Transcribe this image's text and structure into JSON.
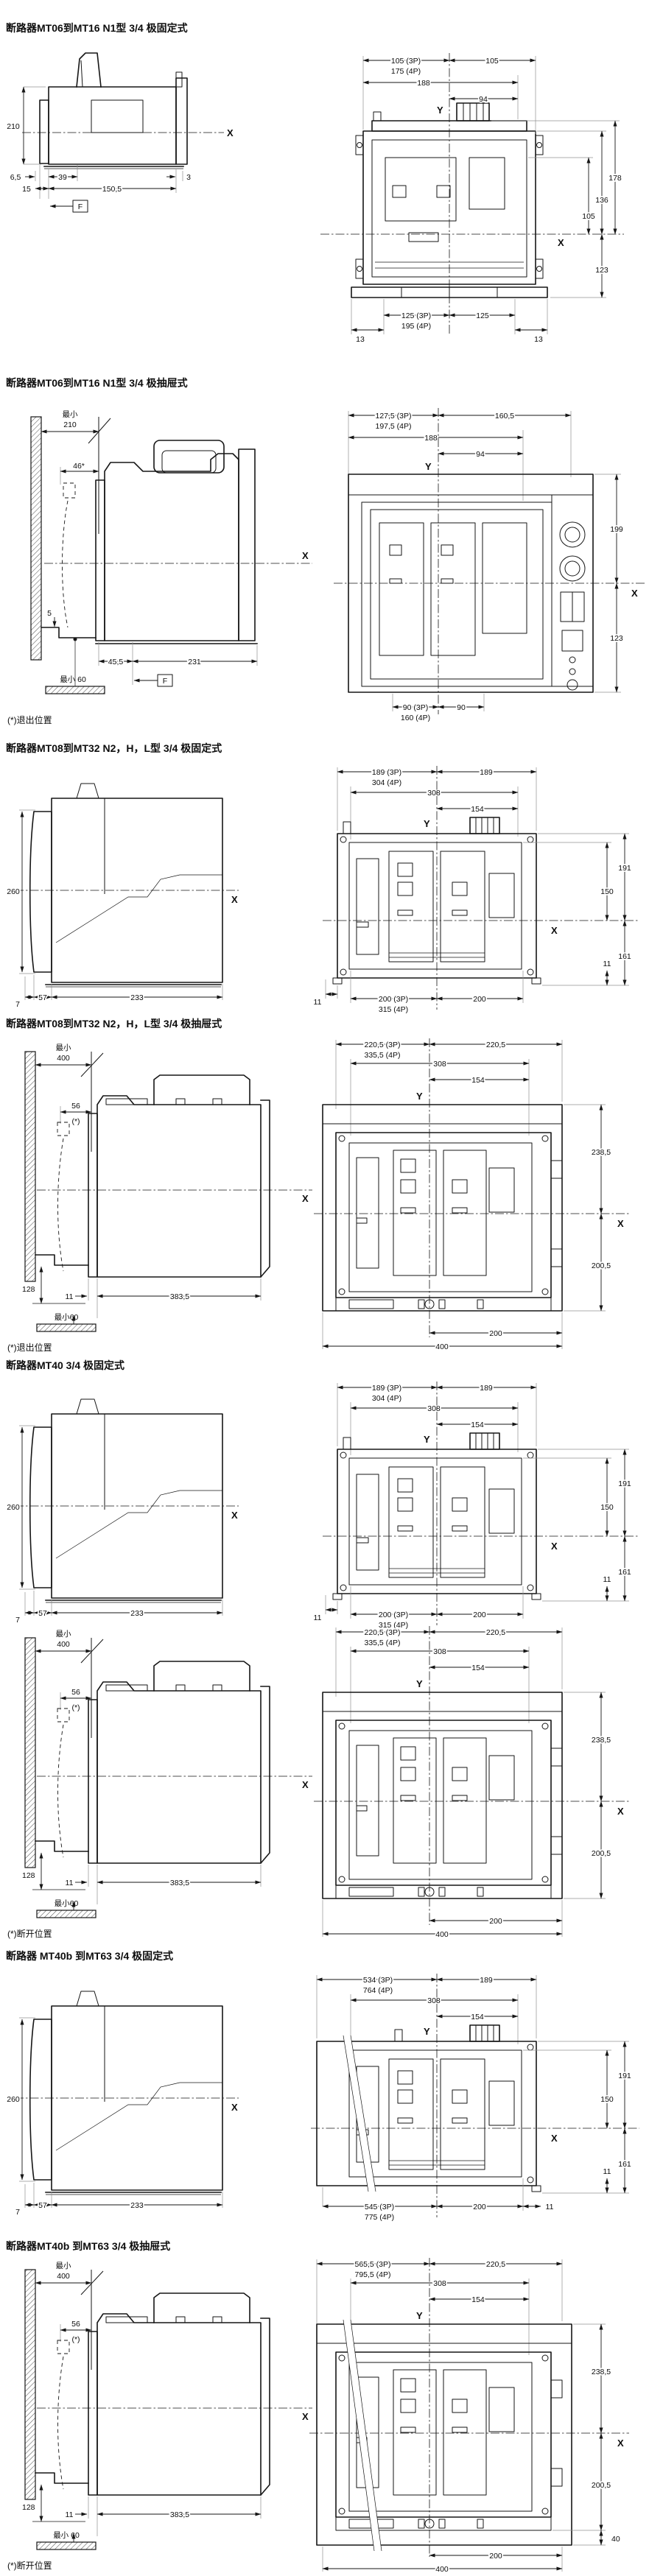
{
  "sections": [
    {
      "title": "断路器MT06到MT16 N1型 3/4 极固定式",
      "side": {
        "h": "210",
        "d1": "6,5",
        "d2": "39",
        "d3": "3",
        "d4": "15",
        "d5": "150,5",
        "f": "F",
        "axis_x": "X"
      },
      "front": {
        "w1a": "105 (3P)",
        "w1b": "175 (4P)",
        "w1r": "105",
        "w2": "188",
        "w3": "94",
        "y": "Y",
        "x": "X",
        "r1": "178",
        "r2": "136",
        "r3": "105",
        "r4": "123",
        "b1a": "125 (3P)",
        "b1b": "195 (4P)",
        "b1r": "125",
        "e1": "13",
        "e2": "13"
      }
    },
    {
      "title": "断路器MT06到MT16 N1型 3/4 极抽屉式",
      "side": {
        "min1": "最小",
        "min2": "210",
        "door": "46*",
        "step": "5",
        "floor": "最小 60",
        "d1": "45,5",
        "d2": "231",
        "f": "F",
        "axis_x": "X",
        "note": "(*)退出位置"
      },
      "front": {
        "w1a": "127,5 (3P)",
        "w1b": "197,5 (4P)",
        "w1r": "160,5",
        "w2": "188",
        "w3": "94",
        "y": "Y",
        "x": "X",
        "r1": "199",
        "r2": "123",
        "b1a": "90 (3P)",
        "b1b": "160 (4P)",
        "b1r": "90"
      }
    },
    {
      "title": "断路器MT08到MT32 N2，H，L型 3/4 极固定式",
      "side": {
        "h": "260",
        "d1": "7",
        "d2": "57",
        "d3": "233",
        "axis_x": "X"
      },
      "front": {
        "w1a": "189 (3P)",
        "w1b": "304 (4P)",
        "w1r": "189",
        "w2": "308",
        "w3": "154",
        "y": "Y",
        "x": "X",
        "r1": "191",
        "r2": "150",
        "r3": "161",
        "r4": "11",
        "b1a": "200 (3P)",
        "b1b": "315 (4P)",
        "b1r": "200",
        "e1": "11"
      }
    },
    {
      "title": "断路器MT08到MT32 N2，H，L型 3/4 极抽屉式",
      "side": {
        "min1": "最小",
        "min2": "400",
        "door": "56",
        "door_note": "(*)",
        "h128": "128",
        "floor": "最小60",
        "d1": "11",
        "d2": "383,5",
        "axis_x": "X",
        "note": "(*)退出位置"
      },
      "front": {
        "w1a": "220,5 (3P)",
        "w1b": "335,5 (4P)",
        "w1r": "220,5",
        "w2": "308",
        "w3": "154",
        "y": "Y",
        "x": "X",
        "r1": "238,5",
        "r2": "200,5",
        "b1": "200",
        "b2": "400"
      }
    },
    {
      "title": "断路器MT40 3/4 极固定式",
      "side": {
        "h": "260",
        "d1": "7",
        "d2": "57",
        "d3": "233",
        "axis_x": "X"
      },
      "front": {
        "w1a": "189 (3P)",
        "w1b": "304 (4P)",
        "w1r": "189",
        "w2": "308",
        "w3": "154",
        "y": "Y",
        "x": "X",
        "r1": "191",
        "r2": "150",
        "r3": "161",
        "r4": "11",
        "b1a": "200 (3P)",
        "b1b": "315 (4P)",
        "b1r": "200",
        "e1": "11"
      }
    },
    {
      "side": {
        "min1": "最小",
        "min2": "400",
        "door": "56",
        "door_note": "(*)",
        "h128": "128",
        "floor": "最小60",
        "d1": "11",
        "d2": "383,5",
        "axis_x": "X",
        "note": "(*)断开位置"
      },
      "front": {
        "w1a": "220,5 (3P)",
        "w1b": "335,5 (4P)",
        "w1r": "220,5",
        "w2": "308",
        "w3": "154",
        "y": "Y",
        "x": "X",
        "r1": "238,5",
        "r2": "200,5",
        "b1": "200",
        "b2": "400"
      }
    },
    {
      "title": "断路器 MT40b 到MT63 3/4 极固定式",
      "side": {
        "h": "260",
        "d1": "7",
        "d2": "57",
        "d3": "233",
        "axis_x": "X"
      },
      "front": {
        "w1a": "534 (3P)",
        "w1b": "764 (4P)",
        "w1r": "189",
        "w2": "308",
        "w3": "154",
        "y": "Y",
        "x": "X",
        "r1": "191",
        "r2": "150",
        "r3": "161",
        "r4": "11",
        "b1a": "545 (3P)",
        "b1b": "775 (4P)",
        "b1r": "200",
        "e1": "11"
      }
    },
    {
      "title": "断路器MT40b 到MT63 3/4 极抽屉式",
      "side": {
        "min1": "最小",
        "min2": "400",
        "door": "56",
        "door_note": "(*)",
        "h128": "128",
        "floor": "最小 60",
        "d1": "11",
        "d2": "383,5",
        "axis_x": "X",
        "note": "(*)断开位置"
      },
      "front": {
        "w1a": "565,5 (3P)",
        "w1b": "795,5 (4P)",
        "w1r": "220,5",
        "w2": "308",
        "w3": "154",
        "y": "Y",
        "x": "X",
        "r1": "238,5",
        "r2": "200,5",
        "r3": "40",
        "b1": "200",
        "b2": "400"
      }
    }
  ]
}
